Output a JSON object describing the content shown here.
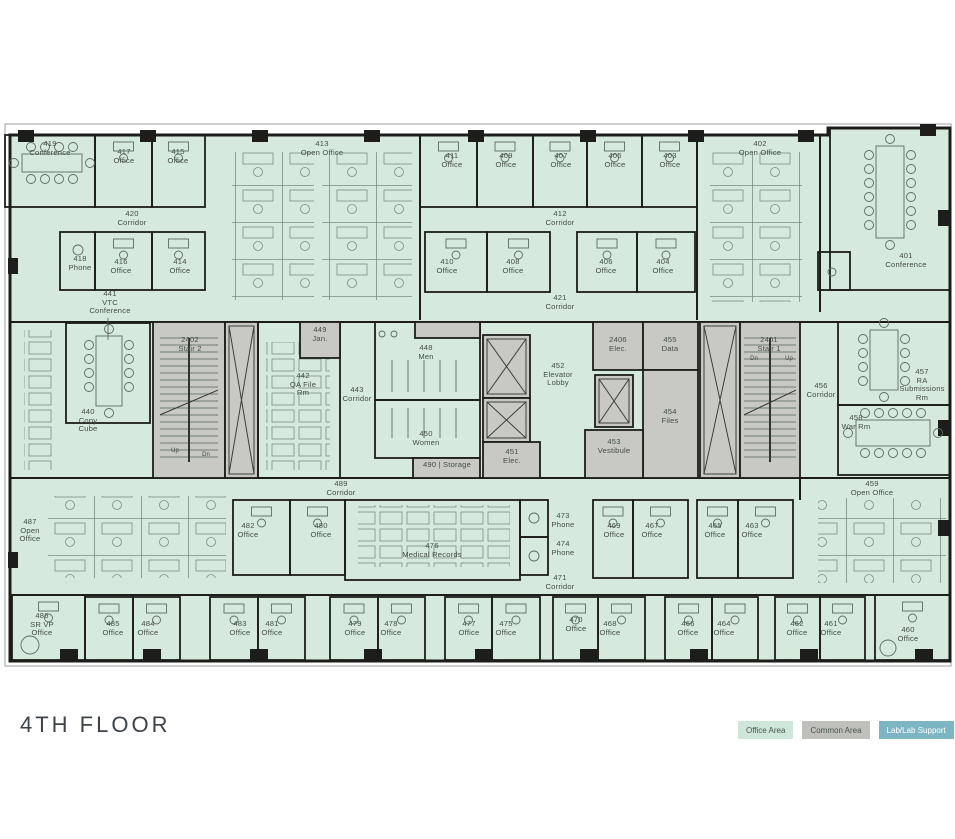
{
  "title": "4TH FLOOR",
  "colors": {
    "office_area": "#d5e9dd",
    "common_area": "#c8c9c3",
    "lab_area": "#7db6c2",
    "wall": "#1d1d1b",
    "furniture": "#6f8178",
    "label_text": "#454e49"
  },
  "legend": {
    "items": [
      {
        "label": "Office Area",
        "bg": "#cfe7da",
        "fg": "#4a544e"
      },
      {
        "label": "Common Area",
        "bg": "#bfc0bb",
        "fg": "#4a544e"
      },
      {
        "label": "Lab/Lab Support",
        "bg": "#7db6c2",
        "fg": "#ffffff"
      }
    ]
  },
  "stair_notes": [
    {
      "text": "Up",
      "x": 175,
      "y": 448
    },
    {
      "text": "Dn",
      "x": 206,
      "y": 452
    },
    {
      "text": "Dn",
      "x": 754,
      "y": 356
    },
    {
      "text": "Up",
      "x": 789,
      "y": 356
    }
  ],
  "rooms": [
    {
      "id": "419",
      "lines": [
        "419",
        "Conference"
      ],
      "type": "office",
      "rect": [
        5,
        135,
        90,
        72
      ],
      "label": [
        50,
        140
      ]
    },
    {
      "id": "417",
      "lines": [
        "417",
        "Office"
      ],
      "type": "office",
      "rect": [
        95,
        135,
        57,
        72
      ],
      "label": [
        124,
        148
      ],
      "desk": true
    },
    {
      "id": "415",
      "lines": [
        "415",
        "Office"
      ],
      "type": "office",
      "rect": [
        152,
        135,
        53,
        72
      ],
      "label": [
        178,
        148
      ],
      "desk": true
    },
    {
      "id": "413",
      "lines": [
        "413",
        "Open Office"
      ],
      "type": "open",
      "label": [
        322,
        140
      ]
    },
    {
      "id": "411",
      "lines": [
        "411",
        "Office"
      ],
      "type": "office",
      "rect": [
        420,
        135,
        57,
        72
      ],
      "label": [
        452,
        152
      ],
      "desk": true
    },
    {
      "id": "409",
      "lines": [
        "409",
        "Office"
      ],
      "type": "office",
      "rect": [
        477,
        135,
        56,
        72
      ],
      "label": [
        506,
        152
      ],
      "desk": true
    },
    {
      "id": "407",
      "lines": [
        "407",
        "Office"
      ],
      "type": "office",
      "rect": [
        533,
        135,
        54,
        72
      ],
      "label": [
        561,
        152
      ],
      "desk": true
    },
    {
      "id": "405",
      "lines": [
        "405",
        "Office"
      ],
      "type": "office",
      "rect": [
        587,
        135,
        55,
        72
      ],
      "label": [
        615,
        152
      ],
      "desk": true
    },
    {
      "id": "403",
      "lines": [
        "403",
        "Office"
      ],
      "type": "office",
      "rect": [
        642,
        135,
        55,
        72
      ],
      "label": [
        670,
        152
      ],
      "desk": true
    },
    {
      "id": "402",
      "lines": [
        "402",
        "Open Office"
      ],
      "type": "open",
      "label": [
        760,
        140
      ]
    },
    {
      "id": "401",
      "lines": [
        "401",
        "Conference"
      ],
      "type": "office",
      "rect": [
        830,
        128,
        120,
        162
      ],
      "label": [
        906,
        252
      ]
    },
    {
      "id": "small-room",
      "type": "office",
      "rect": [
        818,
        252,
        32,
        38
      ]
    },
    {
      "id": "420",
      "lines": [
        "420",
        "Corridor"
      ],
      "type": "corridor",
      "label": [
        132,
        210
      ]
    },
    {
      "id": "412",
      "lines": [
        "412",
        "Corridor"
      ],
      "type": "corridor",
      "label": [
        560,
        210
      ]
    },
    {
      "id": "418",
      "lines": [
        "418",
        "Phone"
      ],
      "type": "office",
      "rect": [
        60,
        232,
        35,
        58
      ],
      "label": [
        80,
        255
      ]
    },
    {
      "id": "416",
      "lines": [
        "416",
        "Office"
      ],
      "type": "office",
      "rect": [
        95,
        232,
        57,
        58
      ],
      "label": [
        121,
        258
      ],
      "desk": true
    },
    {
      "id": "414",
      "lines": [
        "414",
        "Office"
      ],
      "type": "office",
      "rect": [
        152,
        232,
        53,
        58
      ],
      "label": [
        180,
        258
      ],
      "desk": true
    },
    {
      "id": "410",
      "lines": [
        "410",
        "Office"
      ],
      "type": "office",
      "rect": [
        425,
        232,
        62,
        60
      ],
      "label": [
        447,
        258
      ],
      "desk": true
    },
    {
      "id": "408",
      "lines": [
        "408",
        "Office"
      ],
      "type": "office",
      "rect": [
        487,
        232,
        63,
        60
      ],
      "label": [
        513,
        258
      ],
      "desk": true
    },
    {
      "id": "406",
      "lines": [
        "406",
        "Office"
      ],
      "type": "office",
      "rect": [
        577,
        232,
        60,
        60
      ],
      "label": [
        606,
        258
      ],
      "desk": true
    },
    {
      "id": "404",
      "lines": [
        "404",
        "Office"
      ],
      "type": "office",
      "rect": [
        637,
        232,
        58,
        60
      ],
      "label": [
        663,
        258
      ],
      "desk": true
    },
    {
      "id": "421",
      "lines": [
        "421",
        "Corridor"
      ],
      "type": "corridor",
      "label": [
        560,
        294
      ]
    },
    {
      "id": "441",
      "lines": [
        "441",
        "VTC",
        "Conference"
      ],
      "type": "office",
      "rect": [
        66,
        323,
        84,
        100
      ],
      "label": [
        110,
        290
      ]
    },
    {
      "id": "440",
      "lines": [
        "440",
        "Copy",
        "Cube"
      ],
      "type": "open",
      "label": [
        88,
        408
      ]
    },
    {
      "id": "2402",
      "lines": [
        "2402",
        "Stair 2"
      ],
      "type": "common",
      "rect": [
        153,
        322,
        72,
        156
      ],
      "label": [
        190,
        336
      ]
    },
    {
      "id": "shaft-2402",
      "type": "common",
      "rect": [
        225,
        322,
        33,
        156
      ],
      "x_mark": true
    },
    {
      "id": "442",
      "lines": [
        "442",
        "QA File",
        "Rm"
      ],
      "type": "office",
      "rect": [
        258,
        322,
        82,
        156
      ],
      "label": [
        303,
        372
      ]
    },
    {
      "id": "449",
      "lines": [
        "449",
        "Jan."
      ],
      "type": "common",
      "rect": [
        300,
        322,
        40,
        36
      ],
      "label": [
        320,
        326
      ]
    },
    {
      "id": "443",
      "lines": [
        "443",
        "Corridor"
      ],
      "type": "corridor",
      "label": [
        357,
        386
      ]
    },
    {
      "id": "448",
      "lines": [
        "448",
        "Men"
      ],
      "type": "office",
      "rect": [
        375,
        322,
        105,
        78
      ],
      "label": [
        426,
        344
      ]
    },
    {
      "id": "450",
      "lines": [
        "450",
        "Women"
      ],
      "type": "office",
      "rect": [
        375,
        400,
        105,
        58
      ],
      "label": [
        426,
        430
      ]
    },
    {
      "id": "chase",
      "type": "common",
      "rect": [
        415,
        322,
        65,
        16
      ]
    },
    {
      "id": "490",
      "lines": [
        "490 | Storage"
      ],
      "type": "common",
      "rect": [
        413,
        458,
        67,
        20
      ],
      "label": [
        447,
        461
      ]
    },
    {
      "id": "452",
      "lines": [
        "452",
        "Elevator",
        "Lobby"
      ],
      "type": "open",
      "label": [
        558,
        362
      ]
    },
    {
      "id": "elev-a",
      "type": "common",
      "rect": [
        483,
        335,
        47,
        63
      ],
      "x_mark": true
    },
    {
      "id": "elev-b",
      "type": "common",
      "rect": [
        483,
        398,
        47,
        44
      ],
      "x_mark": true
    },
    {
      "id": "451",
      "lines": [
        "451",
        "Elec."
      ],
      "type": "common",
      "rect": [
        483,
        442,
        57,
        36
      ],
      "label": [
        512,
        448
      ]
    },
    {
      "id": "2406",
      "lines": [
        "2406",
        "Elec."
      ],
      "type": "common",
      "rect": [
        593,
        322,
        50,
        48
      ],
      "label": [
        618,
        336
      ]
    },
    {
      "id": "455",
      "lines": [
        "455",
        "Data"
      ],
      "type": "common",
      "rect": [
        643,
        322,
        55,
        48
      ],
      "label": [
        670,
        336
      ]
    },
    {
      "id": "454",
      "lines": [
        "454",
        "Files"
      ],
      "type": "common",
      "rect": [
        643,
        370,
        55,
        108
      ],
      "label": [
        670,
        408
      ]
    },
    {
      "id": "elev-c",
      "type": "common",
      "rect": [
        595,
        375,
        38,
        52
      ],
      "x_mark": true
    },
    {
      "id": "453",
      "lines": [
        "453",
        "Vestibule"
      ],
      "type": "common",
      "rect": [
        585,
        430,
        58,
        48
      ],
      "label": [
        614,
        438
      ]
    },
    {
      "id": "shaft-2401",
      "type": "common",
      "rect": [
        700,
        322,
        40,
        156
      ],
      "x_mark": true
    },
    {
      "id": "2401",
      "lines": [
        "2401",
        "Stair 1"
      ],
      "type": "common",
      "rect": [
        740,
        322,
        60,
        156
      ],
      "label": [
        769,
        336
      ]
    },
    {
      "id": "456",
      "lines": [
        "456",
        "Corridor"
      ],
      "type": "corridor",
      "label": [
        821,
        382
      ]
    },
    {
      "id": "457",
      "lines": [
        "457",
        "RA",
        "Submissions",
        "Rm"
      ],
      "type": "office",
      "rect": [
        838,
        322,
        112,
        83
      ],
      "label": [
        922,
        368
      ]
    },
    {
      "id": "458",
      "lines": [
        "458",
        "War Rm"
      ],
      "type": "office",
      "rect": [
        838,
        405,
        112,
        70
      ],
      "label": [
        856,
        414
      ]
    },
    {
      "id": "459",
      "lines": [
        "459",
        "Open Office"
      ],
      "type": "open",
      "label": [
        872,
        480
      ]
    },
    {
      "id": "487",
      "lines": [
        "487",
        "Open",
        "Office"
      ],
      "type": "open",
      "label": [
        30,
        518
      ]
    },
    {
      "id": "489",
      "lines": [
        "489",
        "Corridor"
      ],
      "type": "corridor",
      "label": [
        341,
        480
      ]
    },
    {
      "id": "482",
      "lines": [
        "482",
        "Office"
      ],
      "type": "office",
      "rect": [
        233,
        500,
        57,
        75
      ],
      "label": [
        248,
        522
      ],
      "desk": true
    },
    {
      "id": "480",
      "lines": [
        "480",
        "Office"
      ],
      "type": "office",
      "rect": [
        290,
        500,
        55,
        75
      ],
      "label": [
        321,
        522
      ],
      "desk": true
    },
    {
      "id": "476",
      "lines": [
        "476",
        "Medical Records"
      ],
      "type": "office",
      "rect": [
        345,
        500,
        175,
        80
      ],
      "label": [
        432,
        542
      ]
    },
    {
      "id": "473",
      "lines": [
        "473",
        "Phone"
      ],
      "type": "office",
      "rect": [
        520,
        500,
        28,
        37
      ],
      "label": [
        563,
        512
      ]
    },
    {
      "id": "474",
      "lines": [
        "474",
        "Phone"
      ],
      "type": "office",
      "rect": [
        520,
        537,
        28,
        38
      ],
      "label": [
        563,
        540
      ]
    },
    {
      "id": "471",
      "lines": [
        "471",
        "Corridor"
      ],
      "type": "corridor",
      "label": [
        560,
        574
      ]
    },
    {
      "id": "469",
      "lines": [
        "469",
        "Office"
      ],
      "type": "office",
      "rect": [
        593,
        500,
        40,
        78
      ],
      "label": [
        614,
        522
      ],
      "desk": true
    },
    {
      "id": "467",
      "lines": [
        "467",
        "Office"
      ],
      "type": "office",
      "rect": [
        633,
        500,
        55,
        78
      ],
      "label": [
        652,
        522
      ],
      "desk": true
    },
    {
      "id": "465",
      "lines": [
        "465",
        "Office"
      ],
      "type": "office",
      "rect": [
        697,
        500,
        41,
        78
      ],
      "label": [
        715,
        522
      ],
      "desk": true
    },
    {
      "id": "463",
      "lines": [
        "463",
        "Office"
      ],
      "type": "office",
      "rect": [
        738,
        500,
        55,
        78
      ],
      "label": [
        752,
        522
      ],
      "desk": true
    },
    {
      "id": "486",
      "lines": [
        "486",
        "SR VP",
        "Office"
      ],
      "type": "office",
      "rect": [
        12,
        595,
        73,
        65
      ],
      "label": [
        42,
        612
      ],
      "desk": true
    },
    {
      "id": "485",
      "lines": [
        "485",
        "Office"
      ],
      "type": "office",
      "rect": [
        85,
        597,
        48,
        63
      ],
      "label": [
        113,
        620
      ],
      "desk": true
    },
    {
      "id": "484",
      "lines": [
        "484",
        "Office"
      ],
      "type": "office",
      "rect": [
        133,
        597,
        47,
        63
      ],
      "label": [
        148,
        620
      ],
      "desk": true
    },
    {
      "id": "483",
      "lines": [
        "483",
        "Office"
      ],
      "type": "office",
      "rect": [
        210,
        597,
        48,
        63
      ],
      "label": [
        240,
        620
      ],
      "desk": true
    },
    {
      "id": "481",
      "lines": [
        "481",
        "Office"
      ],
      "type": "office",
      "rect": [
        258,
        597,
        47,
        63
      ],
      "label": [
        272,
        620
      ],
      "desk": true
    },
    {
      "id": "479",
      "lines": [
        "479",
        "Office"
      ],
      "type": "office",
      "rect": [
        330,
        597,
        48,
        63
      ],
      "label": [
        355,
        620
      ],
      "desk": true
    },
    {
      "id": "478",
      "lines": [
        "478",
        "Office"
      ],
      "type": "office",
      "rect": [
        378,
        597,
        47,
        63
      ],
      "label": [
        391,
        620
      ],
      "desk": true
    },
    {
      "id": "477",
      "lines": [
        "477",
        "Office"
      ],
      "type": "office",
      "rect": [
        445,
        597,
        47,
        63
      ],
      "label": [
        469,
        620
      ],
      "desk": true
    },
    {
      "id": "475",
      "lines": [
        "475",
        "Office"
      ],
      "type": "office",
      "rect": [
        492,
        597,
        48,
        63
      ],
      "label": [
        506,
        620
      ],
      "desk": true
    },
    {
      "id": "470",
      "lines": [
        "470",
        "Office"
      ],
      "type": "office",
      "rect": [
        553,
        597,
        45,
        63
      ],
      "label": [
        576,
        616
      ],
      "desk": true
    },
    {
      "id": "468",
      "lines": [
        "468",
        "Office"
      ],
      "type": "office",
      "rect": [
        598,
        597,
        47,
        63
      ],
      "label": [
        610,
        620
      ],
      "desk": true
    },
    {
      "id": "466",
      "lines": [
        "466",
        "Office"
      ],
      "type": "office",
      "rect": [
        665,
        597,
        47,
        63
      ],
      "label": [
        688,
        620
      ],
      "desk": true
    },
    {
      "id": "464",
      "lines": [
        "464",
        "Office"
      ],
      "type": "office",
      "rect": [
        712,
        597,
        46,
        63
      ],
      "label": [
        724,
        620
      ],
      "desk": true
    },
    {
      "id": "462",
      "lines": [
        "462",
        "Office"
      ],
      "type": "office",
      "rect": [
        775,
        597,
        45,
        63
      ],
      "label": [
        797,
        620
      ],
      "desk": true
    },
    {
      "id": "461",
      "lines": [
        "461",
        "Office"
      ],
      "type": "office",
      "rect": [
        820,
        597,
        45,
        63
      ],
      "label": [
        831,
        620
      ],
      "desk": true
    },
    {
      "id": "460",
      "lines": [
        "460",
        "Office"
      ],
      "type": "office",
      "rect": [
        875,
        595,
        75,
        65
      ],
      "label": [
        908,
        626
      ],
      "desk": true
    }
  ]
}
